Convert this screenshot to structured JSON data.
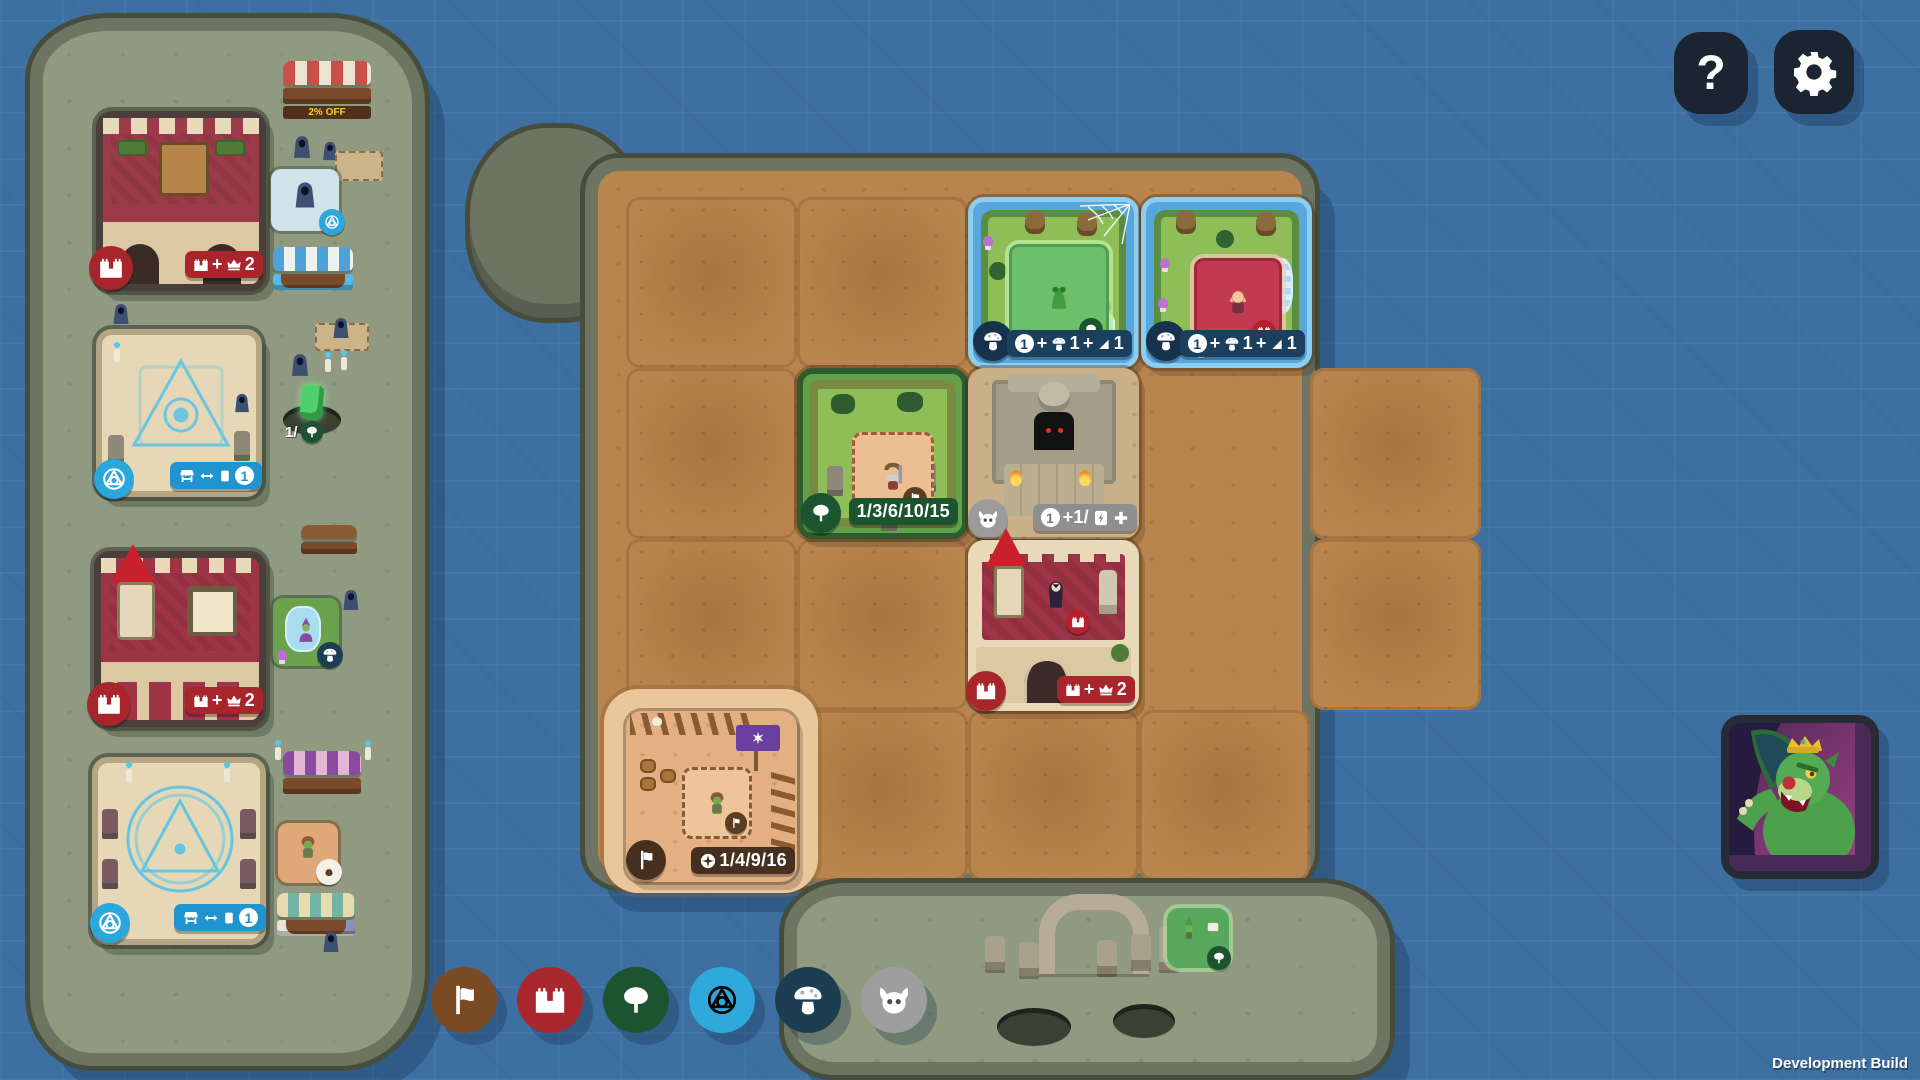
{
  "topbar": {
    "help_label": "?"
  },
  "footer": {
    "dev_build_label": "Development Build"
  },
  "left_island": {
    "shop_sign_label": "2% OFF",
    "crystal_counter": "1/",
    "manor_pill": {
      "plus": "+",
      "count": "2"
    },
    "castle_pill": {
      "plus": "+",
      "count": "2"
    },
    "ritual_top_pill": {
      "coin_value": "1"
    },
    "ritual_bottom_pill": {
      "coin_value": "1"
    }
  },
  "grid": {
    "board_rows": [
      [
        "dirt",
        "dirt",
        "quest-forest-web",
        "quest-forest-falls"
      ],
      [
        "dirt",
        "forest-grove",
        "dungeon-ruins",
        "dirt"
      ],
      [
        "dirt",
        "dirt",
        "red-castle",
        "dirt"
      ],
      [
        "goblin-camp",
        "dirt",
        "dirt",
        "dirt"
      ]
    ],
    "quest_web_pill": {
      "coin_value": "1",
      "plus1": "+",
      "mushroom_count": "1",
      "plus2": "+",
      "tent_count": "1"
    },
    "quest_falls_pill": {
      "coin_value": "1",
      "plus1": "+",
      "mushroom_count": "1",
      "plus2": "+",
      "tent_count": "1"
    },
    "forest_pill_label": "1/3/6/10/15",
    "dungeon_pill": {
      "coin_value": "1",
      "divider": "+1/"
    },
    "castle_pill": {
      "plus": "+",
      "count": "2"
    },
    "camp_pill_label": "1/4/9/16"
  },
  "filters": {
    "items": [
      {
        "name": "flag-filter",
        "color": "#7a4a23"
      },
      {
        "name": "castle-filter",
        "color": "#a8282e"
      },
      {
        "name": "tree-filter",
        "color": "#1d5430"
      },
      {
        "name": "alchemy-filter",
        "color": "#2fa8dc"
      },
      {
        "name": "mushroom-filter",
        "color": "#1d3d52"
      },
      {
        "name": "demon-filter",
        "color": "#9e9e9e"
      }
    ]
  },
  "badge_colors": {
    "red": "#a8252c",
    "dark_green": "#1d5430",
    "navy_circle": "#16324d",
    "navy_pill": "#1d3f5e",
    "cyan": "#2aa7dd",
    "gray_circle": "#9b9b9b",
    "gray_pill": "#8f8f8f",
    "brown": "#45301f",
    "blue_pill": "#2094cf",
    "mini_red": "#b5222c",
    "mini_green": "#1d5430",
    "mini_brown": "#5b3d22"
  }
}
